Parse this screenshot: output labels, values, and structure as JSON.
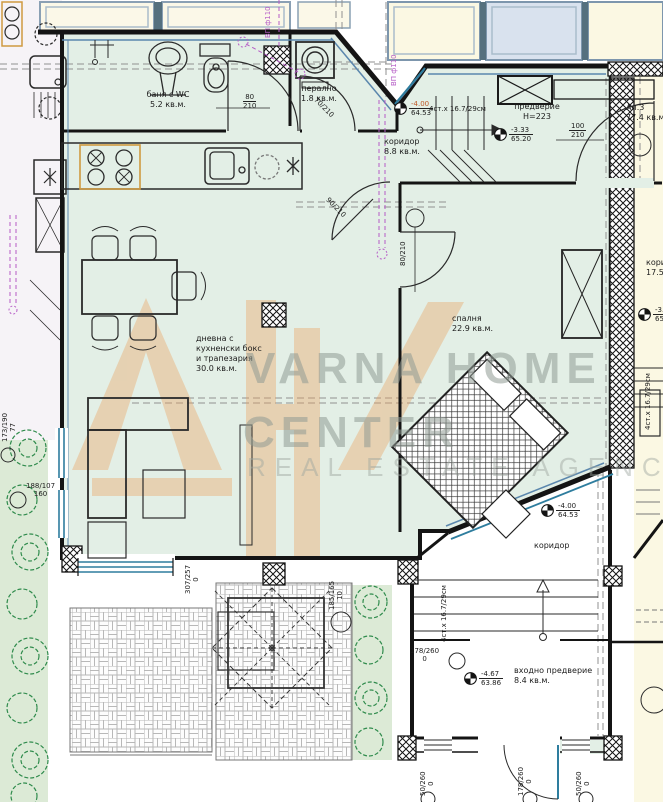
{
  "watermark": {
    "line1": "VARNA HOME",
    "line2": "CENTER",
    "line3": "REAL ESTATE AGENCY",
    "logo_color": "#eba15f",
    "text_color": "#8f9b94"
  },
  "rooms": {
    "bathroom": {
      "name": "баня с WC",
      "area": "5.2 кв.м."
    },
    "laundry": {
      "name": "пералнo",
      "area": "1.8 кв.м."
    },
    "corridor_top": {
      "name": "коридор",
      "area": "8.8 кв.м."
    },
    "vestibule": {
      "name": "предверие",
      "height": "Н=223"
    },
    "apartment": {
      "name": "Ап.3",
      "area": "77.4 кв.м."
    },
    "living": {
      "line1": "дневна с",
      "line2": "кухненски бокс",
      "line3": "и трапезария",
      "area": "30.0 кв.м."
    },
    "bedroom": {
      "name": "спалня",
      "area": "22.9 кв.м."
    },
    "corridor_right": {
      "name": "коридор",
      "area": "17.5"
    },
    "corridor_bottom": {
      "name": "коридор"
    },
    "entry": {
      "name": "входно предверие",
      "area": "8.4 кв.м."
    }
  },
  "levels": {
    "lm1": {
      "top": "-4.00",
      "bottom": "64.53"
    },
    "lm2": {
      "top": "-3.33",
      "bottom": "65.20"
    },
    "lm3": {
      "top": "-3.33",
      "bottom": "65.1"
    },
    "lm4": {
      "top": "-4.00",
      "bottom": "64.53"
    },
    "lm5": {
      "top": "-4.67",
      "bottom": "63.86"
    }
  },
  "stairs": {
    "note": "4ст.х 16.7/29см"
  },
  "pipes": {
    "label": "ВП ф110"
  },
  "dims": {
    "bath_door": {
      "w": "80",
      "h": "210"
    },
    "vestibule_door": {
      "w": "100",
      "h": "210"
    },
    "bedroom_door": {
      "text": "80/210"
    },
    "laundry_door": {
      "text": "70/210"
    },
    "living_door": {
      "text": "90/210"
    },
    "living_window": {
      "text": "307/257",
      "sub": "0"
    },
    "west_window_a": {
      "text": "173/190",
      "sub": "77"
    },
    "west_window_b": {
      "text": "188/107",
      "sub": "160"
    },
    "terrace_window": {
      "text": "185/165",
      "sub": "10"
    },
    "entry_opening": {
      "text": "178/260",
      "sub": "0"
    },
    "south_window_left": {
      "text": "50/260",
      "sub": "0"
    },
    "south_door": {
      "text": "178/260",
      "sub": "0"
    },
    "south_window_right": {
      "text": "50/260",
      "sub": "0"
    }
  },
  "colors": {
    "room_fill": "#e3efe6",
    "neighbor_fill": "#fbf8e3",
    "glass": "#d9e2ee",
    "frame_blue": "#5b87ad",
    "window_teal": "#2e7d9e",
    "magenta": "#b55bc6",
    "grass": "#dcead6",
    "tree": "#2f8b4c",
    "level_orange": "#c05a28"
  }
}
